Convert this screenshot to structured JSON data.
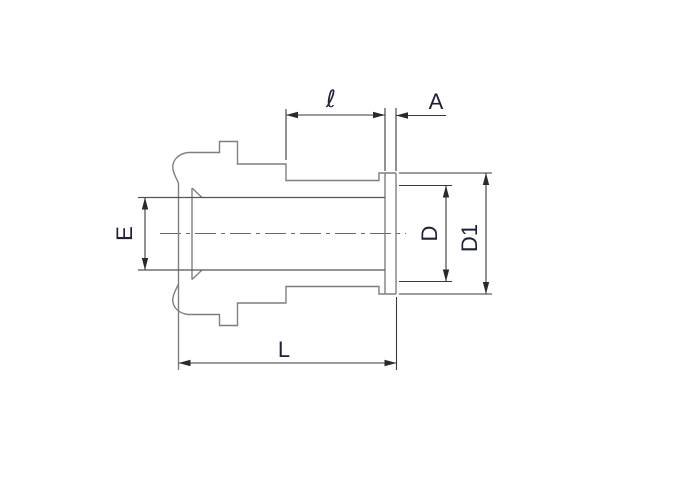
{
  "drawing": {
    "type": "technical-drawing",
    "description": "Side view of a tube gland fitting with stepped nut body, threaded neck and end flange",
    "labels": {
      "ell": "ℓ",
      "a": "A",
      "e": "E",
      "d": "D",
      "d1": "D1",
      "length": "L"
    },
    "dimensions": [
      {
        "id": "ell",
        "label": "ℓ",
        "measures": "neck length to flange back face"
      },
      {
        "id": "a",
        "label": "A",
        "measures": "flange thickness"
      },
      {
        "id": "e",
        "label": "E",
        "measures": "bore diameter"
      },
      {
        "id": "d",
        "label": "D",
        "measures": "face seal diameter"
      },
      {
        "id": "d1",
        "label": "D1",
        "measures": "flange outer diameter"
      },
      {
        "id": "length",
        "label": "L",
        "measures": "overall length"
      }
    ],
    "colors": {
      "background": "#ffffff",
      "outline": "#7f7f7f",
      "bore": "#555555",
      "dimension": "#3a3a3a",
      "arrow": "#2a2a2a",
      "text": "#1f2136",
      "centerline": "#6a6a6a"
    }
  }
}
